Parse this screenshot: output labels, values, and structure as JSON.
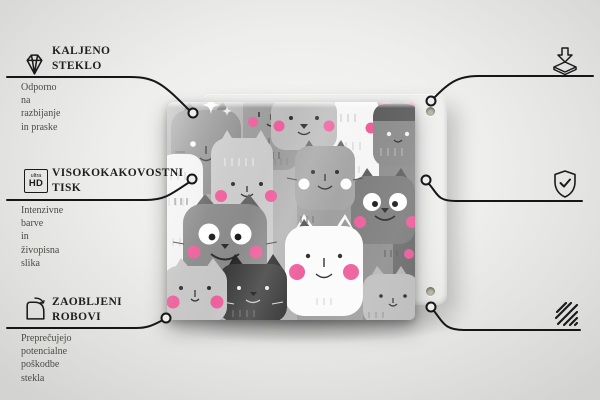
{
  "product": {
    "description": "Tempered glass panel printed with a hand-drawn pattern of gray, white and charcoal cats with pink cheeks, shown in front of a beige mounting board with corner holes",
    "board_color": "#ddd9ca",
    "pattern_pink": "#ee5f9c",
    "line_color": "#161616"
  },
  "callouts": {
    "tempered_glass": {
      "icon": "diamond-icon",
      "title": "KALJENO\nSTEKLO",
      "subtitle": "Odporno na razbijanje\nin praske"
    },
    "high_quality_print": {
      "icon": "ultra-hd-icon",
      "icon_text_top": "ultra",
      "icon_text_bottom": "HD",
      "title": "VISOKOKAKOVOSTNI\nTISK",
      "subtitle": "Intenzivne barve\nin živopisna slika"
    },
    "rounded_edges": {
      "icon": "rounded-corner-icon",
      "title": "ZAOBLJENI\nROBOVI",
      "subtitle": "Preprečujejo potencialne\npoškodbe stekla"
    },
    "anti_slip_pads": {
      "icon": "anti-slip-pad-icon",
      "title": "PROTIDRSNE\nPODLOGE",
      "subtitle": "Samolepilne gumijaste\nblazinice priložene\nv kompletu"
    },
    "protective_film": {
      "icon": "shield-check-icon",
      "title": "ZAŠČITNA\nFOLIJA",
      "subtitle": "Ščiti zadnji del izdelka"
    },
    "polished_edges": {
      "icon": "polished-edges-icon",
      "title": "POLIRANI\nROBOVI",
      "subtitle": "Gladka in varna\nkončna obdelava"
    }
  }
}
